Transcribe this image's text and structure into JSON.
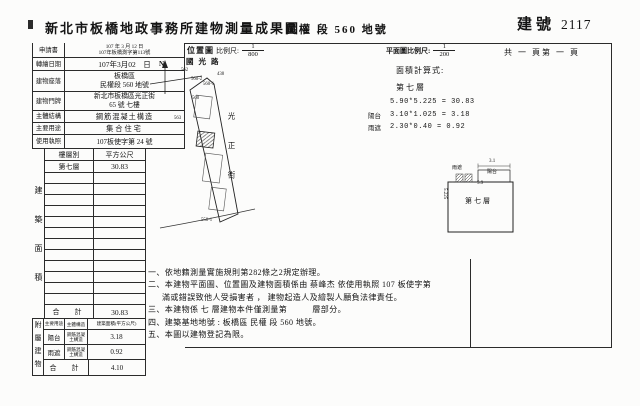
{
  "header": {
    "title": "新北市板橋地政事務所建物測量成果圖",
    "section_label": "民權 段 560 地號",
    "building_no_label": "建號",
    "building_no": "2117"
  },
  "location_map": {
    "label": "位置圖",
    "scale_label": "比例尺:",
    "scale_numerator": "1",
    "scale_denominator": "800",
    "north_label": "N",
    "street_top": "國光路",
    "street_right": "光正街",
    "lots": {
      "l562": "562",
      "l560_2": "560-2",
      "l560_1": "560-1",
      "l438": "438",
      "l560": "560",
      "l563": "563",
      "l558_1": "558-1"
    }
  },
  "plan_area": {
    "scale_label": "平面圖比例尺:",
    "scale_numerator": "1",
    "scale_denominator": "200",
    "pages": "共 一 頁第 一 頁",
    "calc_title": "面積計算式:",
    "calc_floor": "第七層",
    "formulas": [
      {
        "prefix": "",
        "expr": "5.90*5.225 = 30.83"
      },
      {
        "prefix": "陽台",
        "expr": "3.10*1.025 = 3.18"
      },
      {
        "prefix": "雨遮",
        "expr": "2.30*0.40 = 0.92"
      }
    ],
    "plan": {
      "floor_label": "第七層",
      "dim_top": "5.9",
      "dim_left": "5.225",
      "balcony_label": "陽台",
      "balcony_dim": "3.1",
      "canopy_label": "雨遮"
    }
  },
  "info_table": {
    "rows": [
      {
        "label": "申請書",
        "value": "107 年 3 月 12 日",
        "value2": "107年板橋測字第113號"
      },
      {
        "label": "轉繪日期",
        "value": "107年3月02　日"
      },
      {
        "label": "建物座落",
        "value": "板橋區",
        "value2": "民權段 560 地號"
      },
      {
        "label": "建物門牌",
        "value": "新北市板橋區光正街",
        "value2": "65 號 七樓"
      },
      {
        "label": "主體結構",
        "value": "鋼筋混凝土構造"
      },
      {
        "label": "主要用途",
        "value": "集合住宅"
      },
      {
        "label": "使用執照",
        "value": "107板使字第 24 號"
      }
    ]
  },
  "floor_table": {
    "side_label": "建築面積",
    "col1": "樓層別",
    "col2": "平方公尺",
    "rows": [
      {
        "floor": "第七層",
        "area": "30.83"
      }
    ],
    "total_label": "合　計",
    "total_value": "30.83"
  },
  "annex_table": {
    "side_label": "附屬建物",
    "col1": "主要用途",
    "col2": "主體構造",
    "col3": "建築面積(平方公尺)",
    "rows": [
      {
        "use": "陽台",
        "structure": "鋼筋混凝土構造",
        "area": "3.18"
      },
      {
        "use": "雨遮",
        "structure": "鋼筋混凝土構造",
        "area": "0.92"
      }
    ],
    "total_label": "合　計",
    "total_value": "4.10"
  },
  "notes": [
    "一、依地籍測量實施規則第282條之2規定辦理。",
    "二、本建物平面圖、位置圖及建物面積係由 蔡峰杰 依使用執照 107 板使字第",
    "滿或錯誤致他人受損害者 ， 建物起造人及繪製人願負法律責任。",
    "三、本建物係 七 層建物本件僅測量第　　　層部分。",
    "四、建築基地地號 : 板橋區 民權 段 560 地號。",
    "五、本圖以建物登記為限。"
  ]
}
